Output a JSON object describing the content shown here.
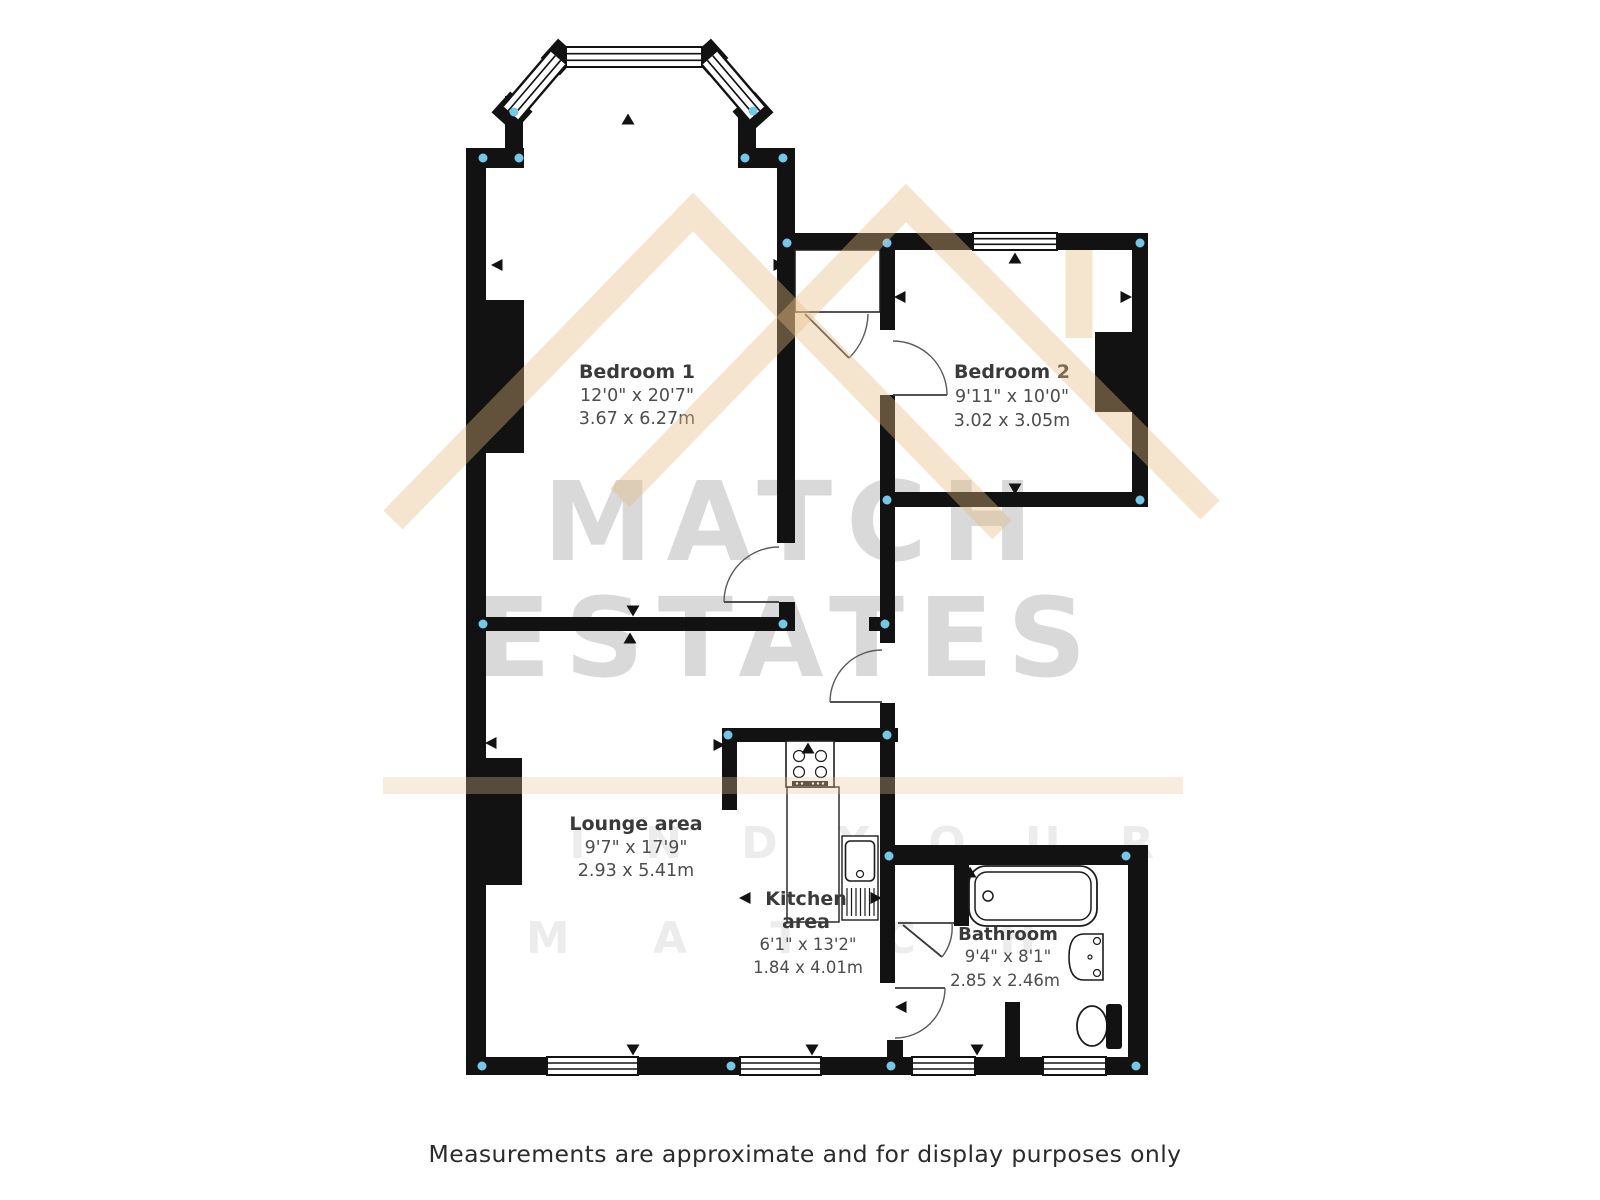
{
  "watermark": {
    "brand_line1": "MATCH",
    "brand_line2": "ESTATES",
    "tagline_line1": "F I N D   Y O U R",
    "tagline_line2": "M A T C H",
    "text_color": "#d9d9d9",
    "roof_color": "#e4ba82"
  },
  "rooms": {
    "bedroom1": {
      "name": "Bedroom 1",
      "imperial": "12'0\" x 20'7\"",
      "metric": "3.67 x 6.27m"
    },
    "bedroom2": {
      "name": "Bedroom 2",
      "imperial": "9'11\" x 10'0\"",
      "metric": "3.02 x 3.05m"
    },
    "lounge": {
      "name": "Lounge area",
      "imperial": "9'7\" x 17'9\"",
      "metric": "2.93 x 5.41m"
    },
    "kitchen": {
      "name_line1": "Kitchen",
      "name_line2": "area",
      "imperial": "6'1\" x 13'2\"",
      "metric": "1.84 x 4.01m"
    },
    "bathroom": {
      "name": "Bathroom",
      "imperial": "9'4\" x 8'1\"",
      "metric": "2.85 x 2.46m"
    }
  },
  "footer": {
    "disclaimer": "Measurements are approximate and for display purposes only"
  },
  "colors": {
    "wall": "#121212",
    "junction_dot": "#74c7e6",
    "floor": "#ffffff"
  }
}
